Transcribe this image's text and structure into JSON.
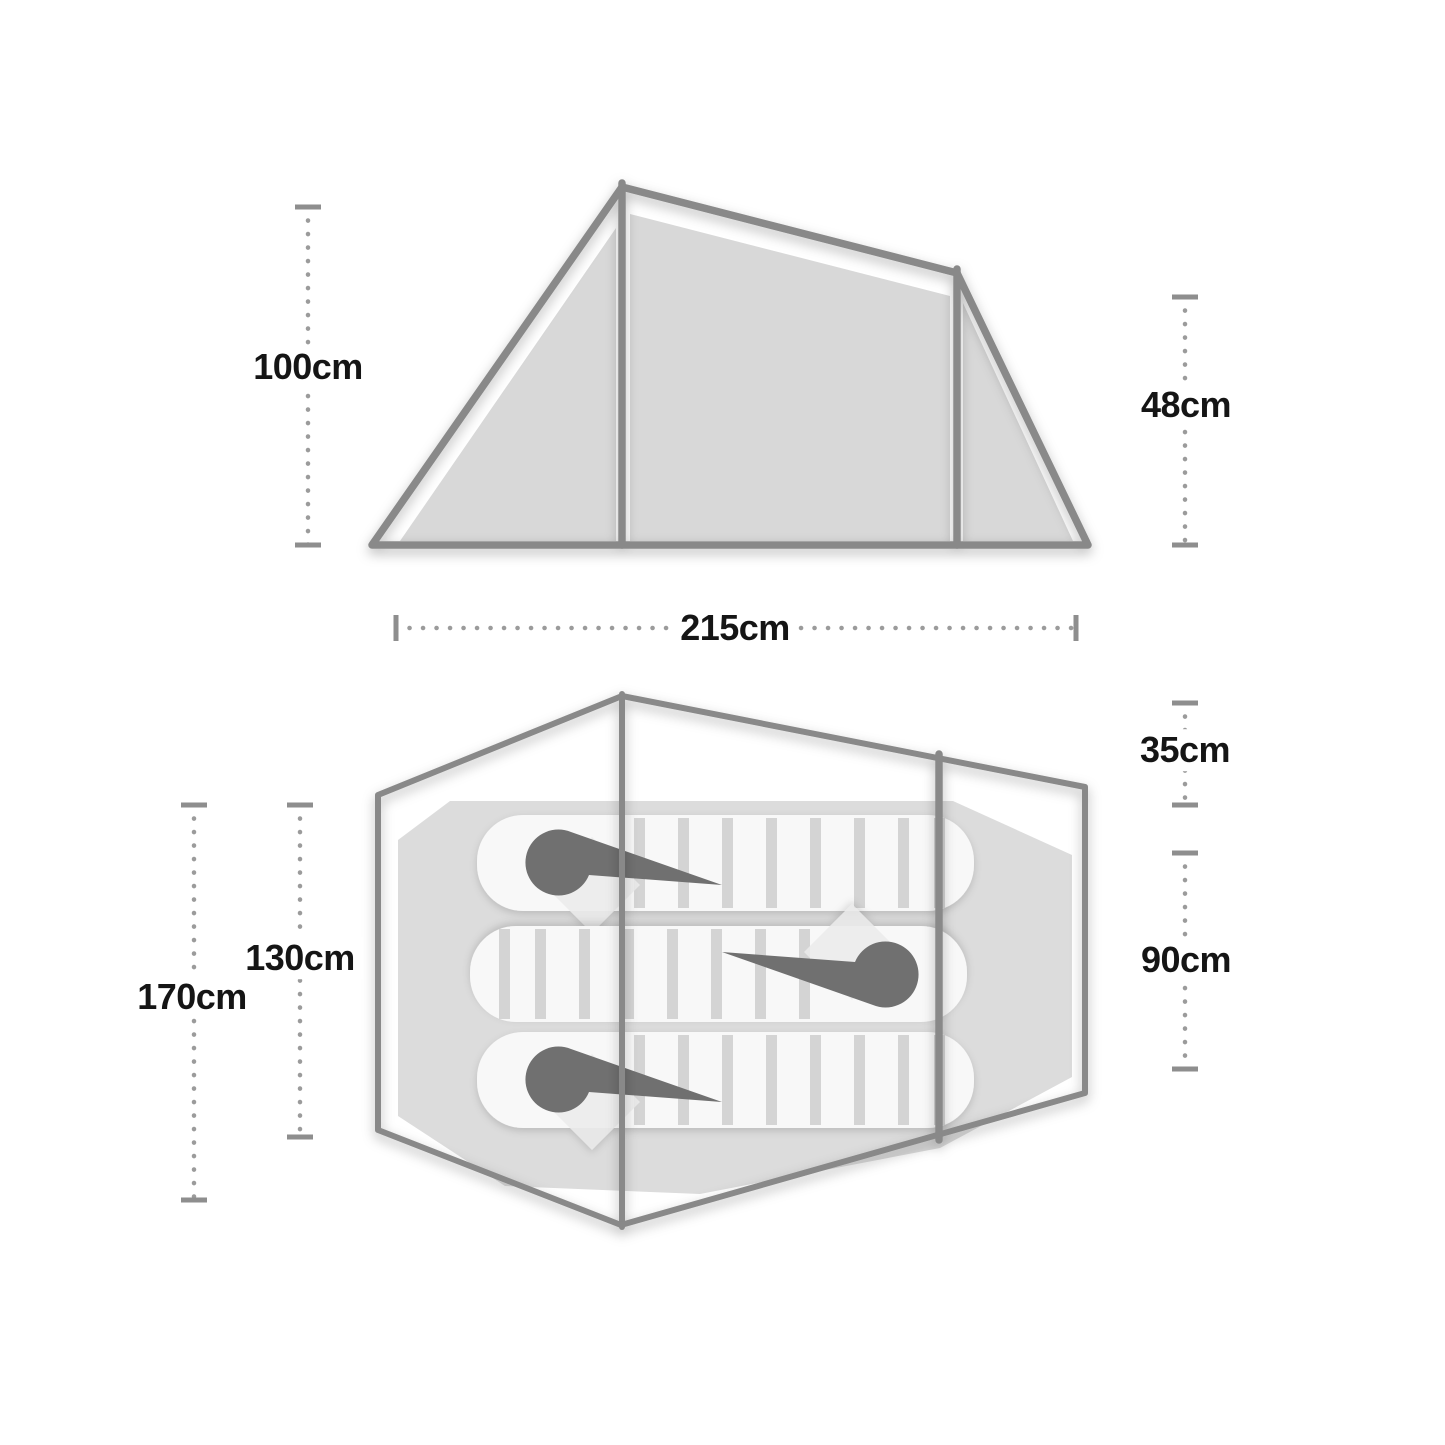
{
  "colors": {
    "background": "#ffffff",
    "outline": "#898989",
    "tent_fill": "#d8d8d8",
    "floor_fill": "#dcdcdc",
    "bag_fill": "#f8f8f8",
    "rib_gap": "#d4d4d4",
    "hood": "#6f6f6f",
    "dotted_line": "#9b9b9b",
    "cap": "#8e8e8e",
    "label_text": "#151515"
  },
  "side_view": {
    "height_left": "100cm",
    "height_right": "48cm",
    "width": "215cm"
  },
  "floor_plan": {
    "porch_depth": "35cm",
    "inner_width": "90cm",
    "inner_length": "130cm",
    "outer_length": "170cm"
  }
}
